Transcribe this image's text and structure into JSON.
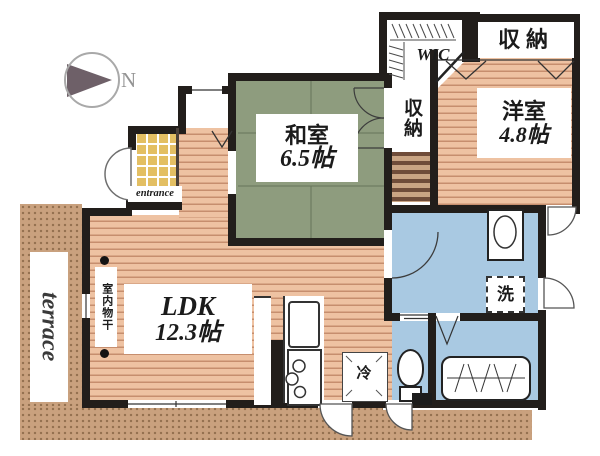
{
  "compass": {
    "north_label": "N"
  },
  "rooms": {
    "ldk": {
      "name": "LDK",
      "size": "12.3帖"
    },
    "washitsu": {
      "name": "和室",
      "size": "6.5帖"
    },
    "yoshitsu": {
      "name": "洋室",
      "size": "4.8帖"
    },
    "wic": {
      "label": "WIC"
    },
    "closet_top": {
      "label": "収納"
    },
    "closet_mid": {
      "label": "収納"
    },
    "terrace": {
      "label": "terrace"
    },
    "entrance": {
      "label": "entrance"
    }
  },
  "fixtures": {
    "indoor_drying": "室内物干",
    "washer": "洗",
    "refrigerator": "冷"
  },
  "colors": {
    "wall": "#221e1b",
    "wood_floor": "#eec2a2",
    "wood_line": "#c68e6e",
    "tatami": "#8e9c7e",
    "wet_area": "#a9c9e2",
    "terrace": "#c9a17e",
    "entrance_tile": "#e3bf63"
  }
}
